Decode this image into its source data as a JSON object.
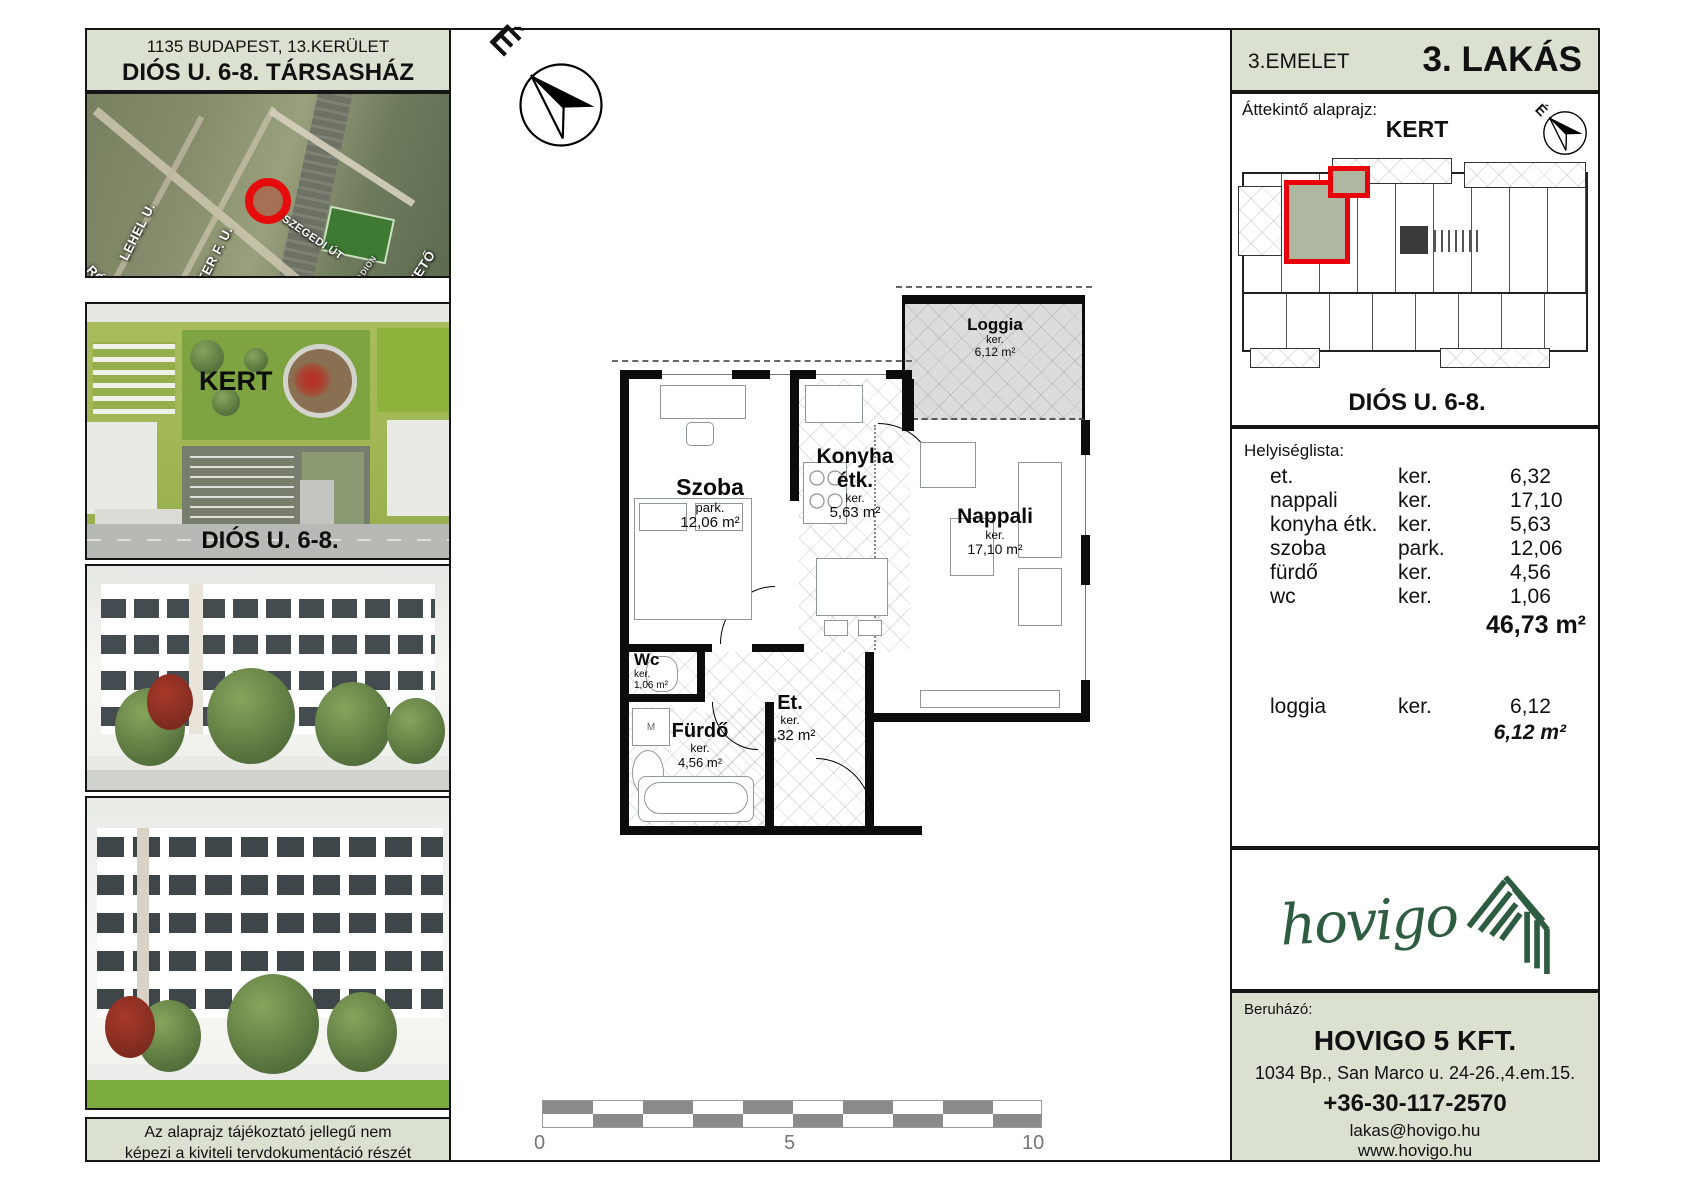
{
  "colors": {
    "panel_green": "#dbe1d0",
    "logo_green": "#2d5c40",
    "highlight_red": "#e8000a",
    "scale_gray": "#8a8a8a"
  },
  "left_panel": {
    "header": {
      "line1": "1135 BUDAPEST, 13.KERÜLET",
      "line2": "DIÓS U. 6-8. TÁRSASHÁZ"
    },
    "map": {
      "labels": [
        "LEHEL U.",
        "RÓBERT KÁROLY KRT",
        "REITTER F. U.",
        "SZEGEDI ÚT",
        "M3 BEVEZETŐ",
        "BVSC STADION"
      ]
    },
    "site_plan": {
      "kert_label": "KERT",
      "street_label": "DIÓS U. 6-8."
    },
    "disclaimer": {
      "line1": "Az alaprajz tájékoztató jellegű nem",
      "line2": "képezi a kiviteli tervdokumentáció részét"
    }
  },
  "floor_plan": {
    "north_label": "É",
    "rooms": [
      {
        "name": "Loggia",
        "tenure": "ker.",
        "area": "6,12 m²"
      },
      {
        "name": "Szoba",
        "tenure": "park.",
        "area": "12,06 m²"
      },
      {
        "name": "Konyha étk.",
        "tenure": "ker.",
        "area": "5,63 m²"
      },
      {
        "name": "Nappali",
        "tenure": "ker.",
        "area": "17,10 m²"
      },
      {
        "name": "Wc",
        "tenure": "ker.",
        "area": "1,06 m²"
      },
      {
        "name": "Fürdő",
        "tenure": "ker.",
        "area": "4,56 m²"
      },
      {
        "name": "Et.",
        "tenure": "ker.",
        "area": "6,32 m²"
      }
    ],
    "appliance_label": "M",
    "scale_bar": {
      "labels": [
        "0",
        "5",
        "10"
      ]
    }
  },
  "right_panel": {
    "header": {
      "floor": "3.EMELET",
      "unit": "3. LAKÁS"
    },
    "overview": {
      "title": "Áttekintő alaprajz:",
      "kert_label": "KERT",
      "north_label": "É",
      "street_label": "DIÓS U. 6-8."
    },
    "room_list": {
      "title": "Helyiséglista:",
      "rows": [
        {
          "name": "et.",
          "tenure": "ker.",
          "area": "6,32"
        },
        {
          "name": "nappali",
          "tenure": "ker.",
          "area": "17,10"
        },
        {
          "name": "konyha étk.",
          "tenure": "ker.",
          "area": "5,63"
        },
        {
          "name": "szoba",
          "tenure": "park.",
          "area": "12,06"
        },
        {
          "name": "fürdő",
          "tenure": "ker.",
          "area": "4,56"
        },
        {
          "name": "wc",
          "tenure": "ker.",
          "area": "1,06"
        }
      ],
      "total": "46,73 m²",
      "loggia_row": {
        "name": "loggia",
        "tenure": "ker.",
        "area": "6,12"
      },
      "loggia_total": "6,12 m²"
    },
    "logo": {
      "wordmark": "hovigo"
    },
    "developer": {
      "label": "Beruházó:",
      "name": "HOVIGO 5 KFT.",
      "address": "1034 Bp., San Marco u. 24-26.,4.em.15.",
      "phone": "+36-30-117-2570",
      "email": "lakas@hovigo.hu",
      "website": "www.hovigo.hu"
    }
  }
}
